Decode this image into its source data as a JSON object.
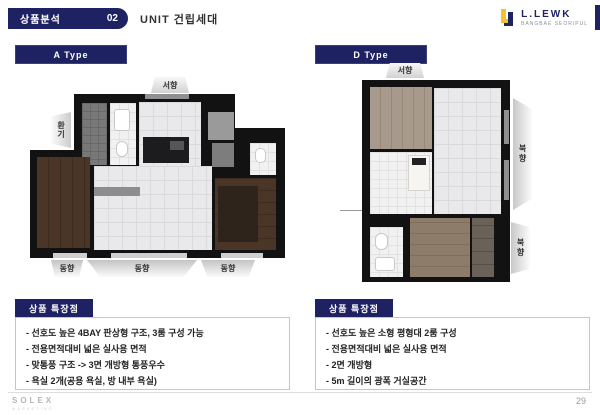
{
  "header": {
    "section_label": "상품분석",
    "section_number": "02",
    "title": "UNIT 건립세대"
  },
  "logo": {
    "name": "L.LEWK",
    "subtitle": "BANGBAE SEORIPUL"
  },
  "a_type": {
    "label": "A Type",
    "flags": {
      "top": "서향",
      "left": "환기",
      "bottom_1": "동향",
      "bottom_2": "동향",
      "bottom_3": "동향"
    },
    "features": {
      "title": "상품 특장점",
      "items": [
        "- 선호도 높은 4BAY 판상형 구조, 3룸 구성 가능",
        "- 전용면적대비 넓은 실사용 면적",
        "- 맞통풍 구조 -> 3면 개방형 통풍우수",
        "- 욕실 2개(공용 욕실, 방 내부 욕실)"
      ]
    }
  },
  "d_type": {
    "label": "D Type",
    "flags": {
      "top": "서향",
      "right_1": "북향",
      "right_2": "북향"
    },
    "features": {
      "title": "상품 특장점",
      "items": [
        "- 선호도 높은 소형 평형대 2룸 구성",
        "- 전용면적대비 넓은 실사용 면적",
        "- 2면 개방형",
        "- 5m 길이의 광폭 거실공간"
      ]
    }
  },
  "footer": {
    "brand": "SOLEX",
    "brand_sub": "MARKETING",
    "page": "29"
  },
  "colors": {
    "navy": "#1e2263",
    "gold": "#f2c12e"
  }
}
